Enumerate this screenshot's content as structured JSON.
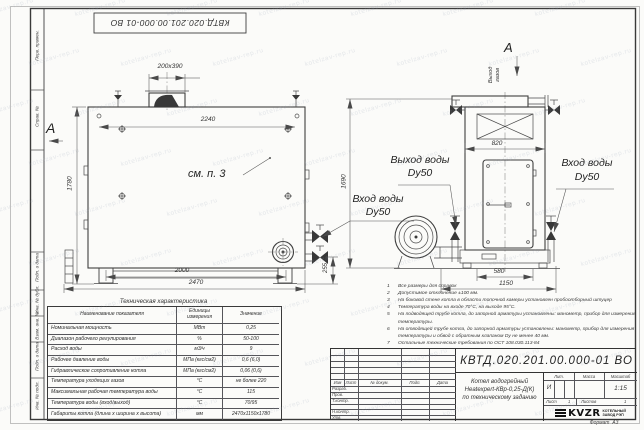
{
  "top_stamp": {
    "doc_number": "КВТД.020.201.00.000-01 ВО"
  },
  "margin": {
    "cell1": "Перв. примен.",
    "cell2": "Справ. №",
    "cell3": "Подп. и дата",
    "cell4": "Инв. № дубл.",
    "cell5": "Взам. инв. №",
    "cell6": "Подп. и дата",
    "cell7": "Инв. № подл."
  },
  "front_view": {
    "marker": "А",
    "ref_note": "см. п. 3",
    "inlet_label": "Вход воды",
    "inlet_dn": "Dy50",
    "dims": {
      "chimney": "200х390",
      "top": "2240",
      "height_left": "1780",
      "height_right": "1690",
      "outlet": "255",
      "bottom_inner": "2000",
      "bottom_overall": "2470"
    }
  },
  "side_view": {
    "marker": "А",
    "gas_outlet_line1": "Выход",
    "gas_outlet_line2": "газов",
    "outlet_label": "Выход воды",
    "outlet_dn": "Dy50",
    "inlet_label": "Вход воды",
    "inlet_dn": "Dy50",
    "dims": {
      "top": "820",
      "base": "580",
      "overall": "1150"
    }
  },
  "notes": {
    "items": [
      {
        "num": "1",
        "text": "Все размеры для справок"
      },
      {
        "num": "2",
        "text": "Допустимое отклонение  ±100 мм."
      },
      {
        "num": "3",
        "text": "На боковой стене котла в области топочной камеры установлен пробоотборный штуцер"
      },
      {
        "num": "4",
        "text": "Температура воды на входе  70°С, на выходе  95°С."
      },
      {
        "num": "5",
        "text": "На подводящей трубе котла, до запорной арматуры установлены: манометр, прибор для измерения температуры."
      },
      {
        "num": "6",
        "text": "На отводящей трубе котла, до запорной арматуры установлены: манометр, прибор для измерения температуры и обвод с обратным клапаном Dу не менее 40 мм."
      },
      {
        "num": "7",
        "text": "Остальные технические требования по ОСТ 108.030.113-84"
      }
    ]
  },
  "tech_table": {
    "title": "Техническая характеристика",
    "col_name": "Наименование показателя",
    "col_units": "Единицы измерения",
    "col_value": "Значение",
    "rows": [
      {
        "name": "Номинальная мощность",
        "units": "МВт",
        "value": "0,25"
      },
      {
        "name": "Диапазон рабочего регулирования",
        "units": "%",
        "value": "50-100"
      },
      {
        "name": "Расход воды",
        "units": "м3/ч",
        "value": "9"
      },
      {
        "name": "Рабочее давление воды",
        "units": "МПа (кгс/см2)",
        "value": "0,6 (6,0)"
      },
      {
        "name": "Гидравлическое сопротивление котла",
        "units": "МПа (кгс/см2)",
        "value": "0,06 (0,6)"
      },
      {
        "name": "Температура уходящих газов",
        "units": "°С",
        "value": "не более 220"
      },
      {
        "name": "Максимальная рабочая температура воды",
        "units": "°С",
        "value": "115"
      },
      {
        "name": "Температура воды (вход/выход)",
        "units": "°С",
        "value": "70/95"
      },
      {
        "name": "Габариты котла (длина х ширина х высота)",
        "units": "мм",
        "value": "2470х1150х1780"
      }
    ]
  },
  "title_block": {
    "doc_number": "КВТД.020.201.00.000-01 ВО",
    "product_line1": "Котел водогрейный",
    "product_line2": "Heatexpert-КВр-0,25-Д(К)",
    "product_line3": "по техническому заданию",
    "lit_label": "Лит.",
    "mass_label": "Масса",
    "scale_label": "Масштаб",
    "lit": "И",
    "scale": "1:15",
    "sheet_label": "Лист",
    "sheet": "1",
    "sheets_label": "Листов",
    "sheets": "1",
    "rev_cols": {
      "izm": "Изм",
      "list": "Лист",
      "ndoc": "№ докум.",
      "podp": "Подп.",
      "data": "Дата"
    },
    "roles": {
      "r1": "Разраб.",
      "r2": "Пров.",
      "r3": "Т.контр.",
      "r4": "Н.контр.",
      "r5": "Утв."
    },
    "logo_text": "KVZR",
    "logo_sub1": "КОТЕЛЬНЫЙ",
    "logo_sub2": "ЗАВОД РЭП",
    "format_label": "Формат",
    "format": "А3"
  },
  "watermark": {
    "text": "kotelzav-rep.ru"
  }
}
